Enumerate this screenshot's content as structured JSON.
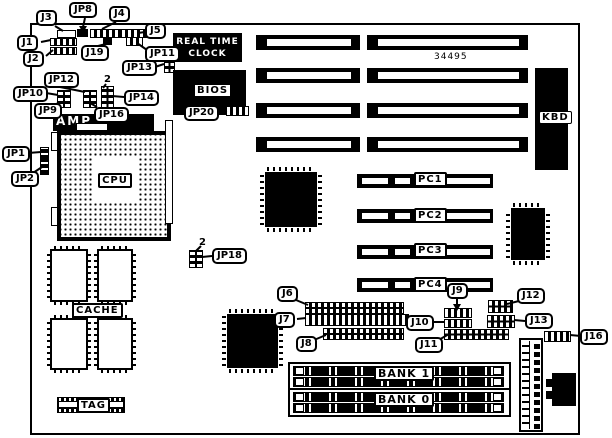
{
  "board_number": "34495",
  "callouts": {
    "j1": "J1",
    "j2": "J2",
    "j3": "J3",
    "j4": "J4",
    "j5": "J5",
    "j6": "J6",
    "j7": "J7",
    "j8": "J8",
    "j9": "J9",
    "j10": "J10",
    "j11": "J11",
    "j12": "J12",
    "j13": "J13",
    "j16": "J16",
    "j19": "J19",
    "jp1": "JP1",
    "jp2": "JP2",
    "jp8": "JP8",
    "jp9": "JP9",
    "jp10": "JP10",
    "jp11": "JP11",
    "jp12": "JP12",
    "jp13": "JP13",
    "jp14": "JP14",
    "jp16": "JP16",
    "jp18": "JP18",
    "jp20": "JP20"
  },
  "components": {
    "rtc_line1": "REAL TIME",
    "rtc_line2": "CLOCK",
    "bios": "BIOS",
    "kbd": "KBD",
    "cpu": "CPU",
    "amp": "AMP",
    "cache": "CACHE",
    "tag": "TAG"
  },
  "slots": {
    "pc1": "PC1",
    "pc2": "PC2",
    "pc3": "PC3",
    "pc4": "PC4",
    "bank1": "BANK 1",
    "bank0": "BANK 0"
  },
  "pin_marks": {
    "jp14": "2",
    "jp18": "2"
  }
}
